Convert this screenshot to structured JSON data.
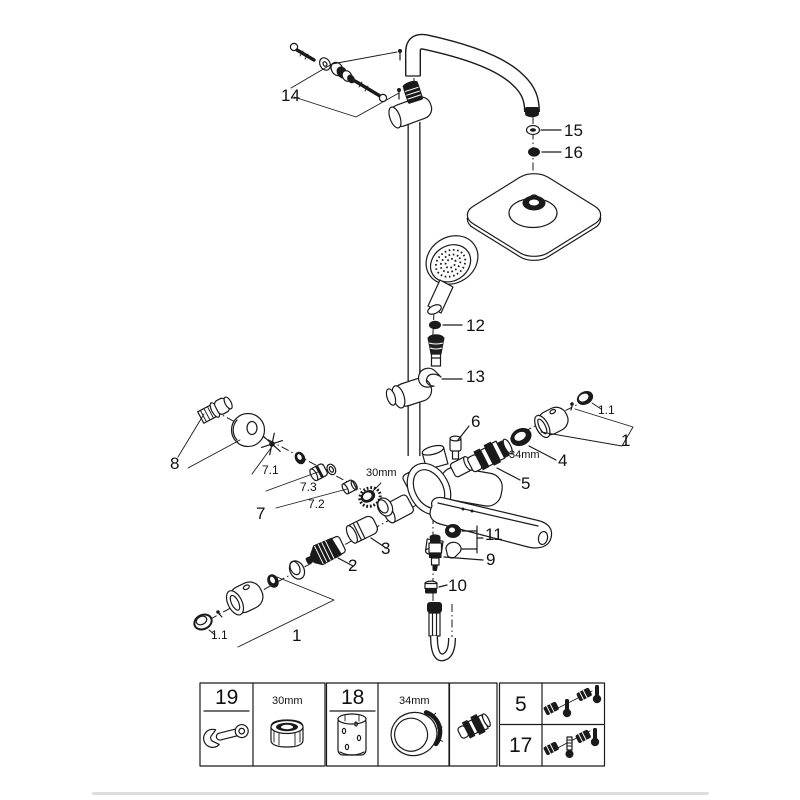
{
  "page": {
    "background": "#ffffff",
    "line_color": "#1a1a1a",
    "divider_color": "#dedede"
  },
  "diagram": {
    "type": "exploded-parts-diagram",
    "subject": "thermostatic shower system with overhead square shower, hand shower and bath mixer",
    "callouts": {
      "n14": "14",
      "n15": "15",
      "n16": "16",
      "n12": "12",
      "n13": "13",
      "n6": "6",
      "n4": "4",
      "n5": "5",
      "n8": "8",
      "n7": "7",
      "n7_1": "7.1",
      "n7_2": "7.2",
      "n7_3": "7.3",
      "n3": "3",
      "n2": "2",
      "n11": "11",
      "n9": "9",
      "n10": "10",
      "n1_right": "1",
      "n1_1_right": "1.1",
      "n1_bottom": "1",
      "n1_1_bottom": "1.1",
      "size_30": "30mm",
      "size_34": "34mm"
    }
  },
  "legend": {
    "boxes": [
      {
        "cells": [
          {
            "label": "19",
            "icon": "open-end-wrench"
          },
          {
            "label": "30mm",
            "icon": "knurled-nut"
          }
        ]
      },
      {
        "cells": [
          {
            "label": "18",
            "icon": "installation-sleeve"
          },
          {
            "label": "34mm",
            "icon": "mounting-ring"
          }
        ]
      },
      {
        "cells": [
          {
            "label": "",
            "icon": "check-valve"
          }
        ]
      },
      {
        "cells": [
          {
            "label": "5",
            "icon": "check-valve-thermometer-set"
          },
          {
            "label": "17",
            "icon": "check-valve-screw-thermometer-set"
          }
        ]
      }
    ]
  }
}
